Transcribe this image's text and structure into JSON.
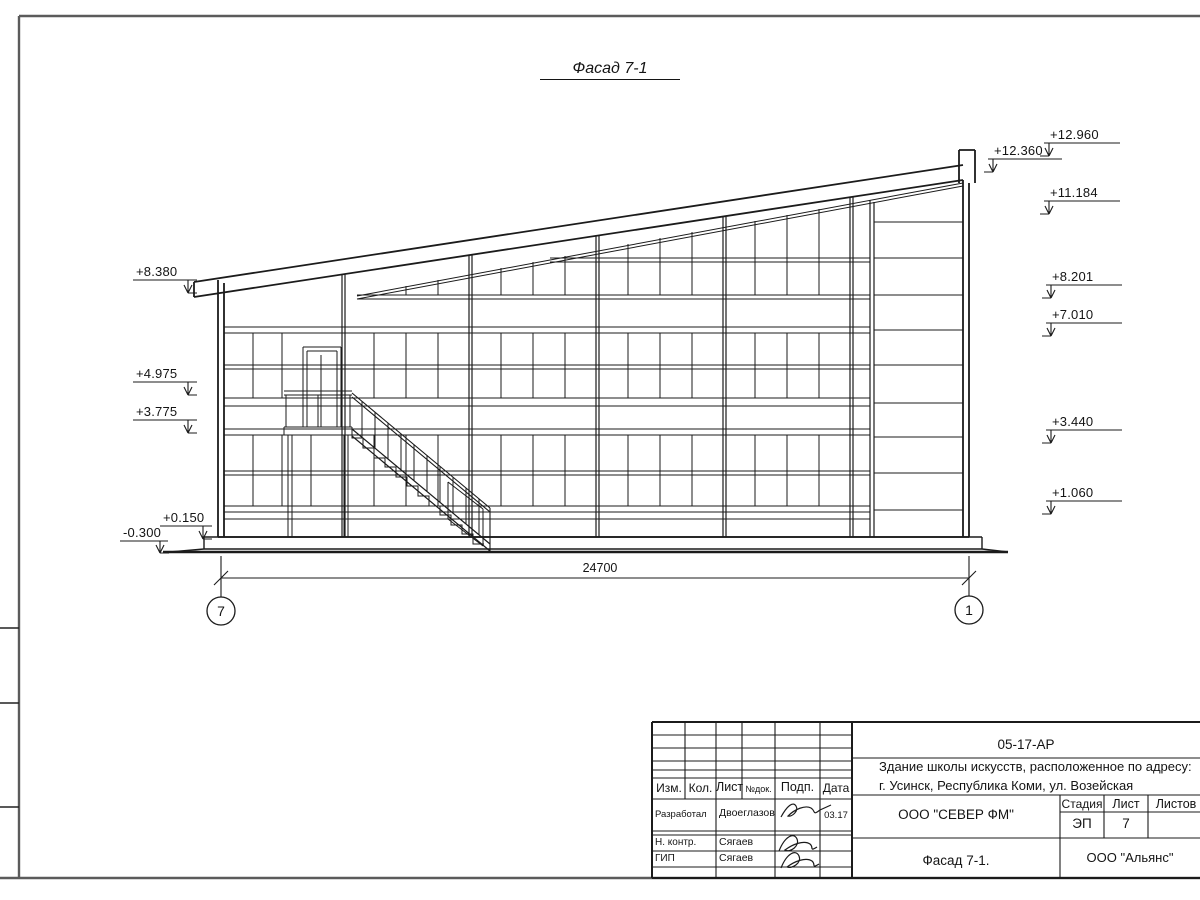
{
  "drawing": {
    "title": "Фасад 7-1"
  },
  "marks": {
    "right": [
      "+12.960",
      "+12.360",
      "+11.184",
      "+8.201",
      "+7.010",
      "+3.440",
      "+1.060"
    ],
    "left": [
      "+8.380",
      "+4.975",
      "+3.775",
      "+0.150",
      "-0.300"
    ]
  },
  "dimension": {
    "total": "24700"
  },
  "axes": {
    "left": "7",
    "right": "1"
  },
  "title_block": {
    "code": "05-17-АР",
    "address": [
      "Здание школы искусств, расположенное по адресу:",
      "г. Усинск, Республика Коми, ул. Возейская"
    ],
    "headers": {
      "izm": "Изм.",
      "kol": "Кол.",
      "list": "Лист",
      "ndok": "№док.",
      "podp": "Подп.",
      "data": "Дата"
    },
    "rows": [
      {
        "role": "Разработал",
        "name": "Двоеглазов",
        "date": "03.17"
      },
      {
        "role": "Н. контр.",
        "name": "Сягаев"
      },
      {
        "role": "ГИП",
        "name": "Сягаев"
      }
    ],
    "org": "ООО \"СЕВЕР ФМ\"",
    "stage_label": "Стадия",
    "sheet_label": "Лист",
    "sheets_label": "Листов",
    "stage": "ЭП",
    "sheet_no": "7",
    "view_title": "Фасад 7-1.",
    "contractor": "ООО \"Альянс\""
  }
}
